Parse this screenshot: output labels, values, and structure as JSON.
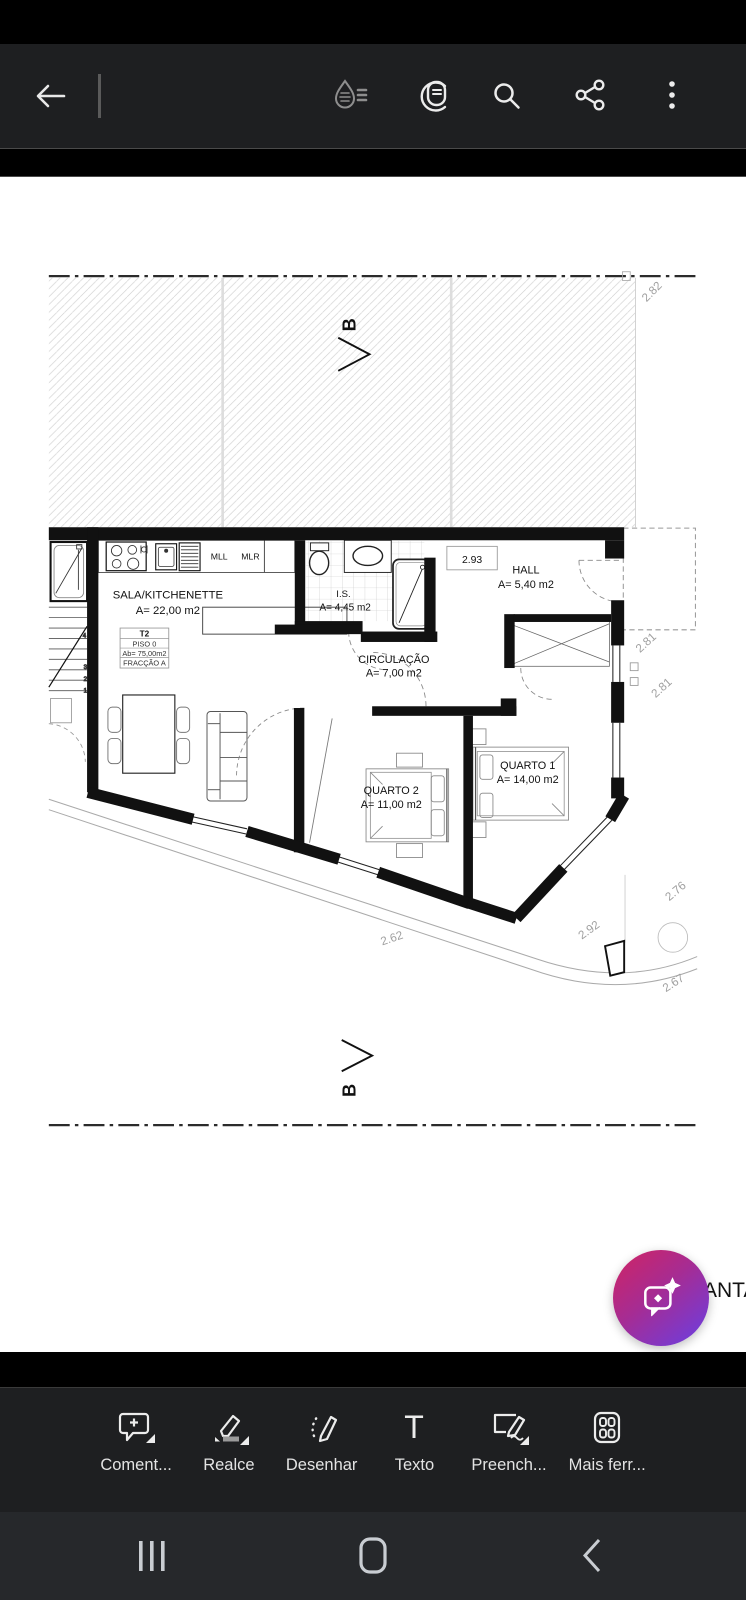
{
  "top_toolbar": {
    "icons": [
      "back-arrow",
      "liquid-mode",
      "view-settings",
      "search",
      "share",
      "overflow-menu"
    ]
  },
  "document": {
    "plan": {
      "section_label": "B",
      "kitchen": {
        "mll": "MLL",
        "mlr": "MLR"
      },
      "sala": {
        "name": "SALA/KITCHENETTE",
        "area": "A= 22,00 m2"
      },
      "unit_box": {
        "line1": "T2",
        "line2": "PISO 0",
        "line3": "Ab= 75,00m2",
        "line4": "FRACÇÃO A"
      },
      "is": {
        "name": "I.S.",
        "area": "A= 4,45 m2"
      },
      "hall": {
        "name": "HALL",
        "area": "A= 5,40 m2",
        "dim": "2.93"
      },
      "circulacao": {
        "name": "CIRCULAÇÃO",
        "area": "A= 7,00 m2"
      },
      "quarto1": {
        "name": "QUARTO 1",
        "area": "A= 14,00 m2"
      },
      "quarto2": {
        "name": "QUARTO 2",
        "area": "A= 11,00 m2"
      },
      "dims": {
        "top_right": "2.82",
        "right1": "2.81",
        "right2": "2.81",
        "right3": "2.76",
        "bottom1": "2.62",
        "bottom2": "2.92",
        "bottom3": "2.67"
      },
      "partial_text": "ANTA"
    }
  },
  "fab": {
    "icon": "ai-chat-sparkle"
  },
  "bottom_toolbar": {
    "items": [
      {
        "icon": "comment-add",
        "label": "Coment..."
      },
      {
        "icon": "highlighter",
        "label": "Realce"
      },
      {
        "icon": "draw-pencil",
        "label": "Desenhar"
      },
      {
        "icon": "text-tool",
        "label": "Texto",
        "glyph": "T"
      },
      {
        "icon": "fill-sign",
        "label": "Preench..."
      },
      {
        "icon": "more-tools",
        "label": "Mais ferr..."
      }
    ]
  },
  "nav_bar": {
    "icons": [
      "recents",
      "home",
      "back"
    ]
  },
  "colors": {
    "toolbar_bg": "#1e1f21",
    "page_bg": "#ffffff",
    "fab_gradient_start": "#c9256b",
    "fab_gradient_end": "#6e3ddd",
    "nav_bg": "#26282b"
  }
}
